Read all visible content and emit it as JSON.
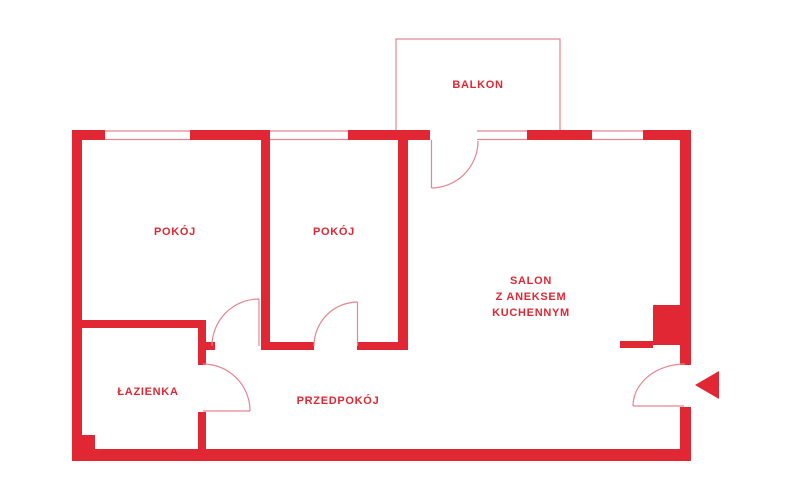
{
  "colors": {
    "background": "#ffffff",
    "wall_red": "#e02733",
    "thin_line_red": "#e5858d",
    "text_red": "#e02733"
  },
  "labels": {
    "balkon": "BALKON",
    "pokoj_left": "POKÓJ",
    "pokoj_middle": "POKÓJ",
    "salon_line1": "SALON",
    "salon_line2": "Z ANEKSEM",
    "salon_line3": "KUCHENNYM",
    "lazienka": "ŁAZIENKA",
    "przedpokoj": "PRZEDPOKÓJ"
  }
}
